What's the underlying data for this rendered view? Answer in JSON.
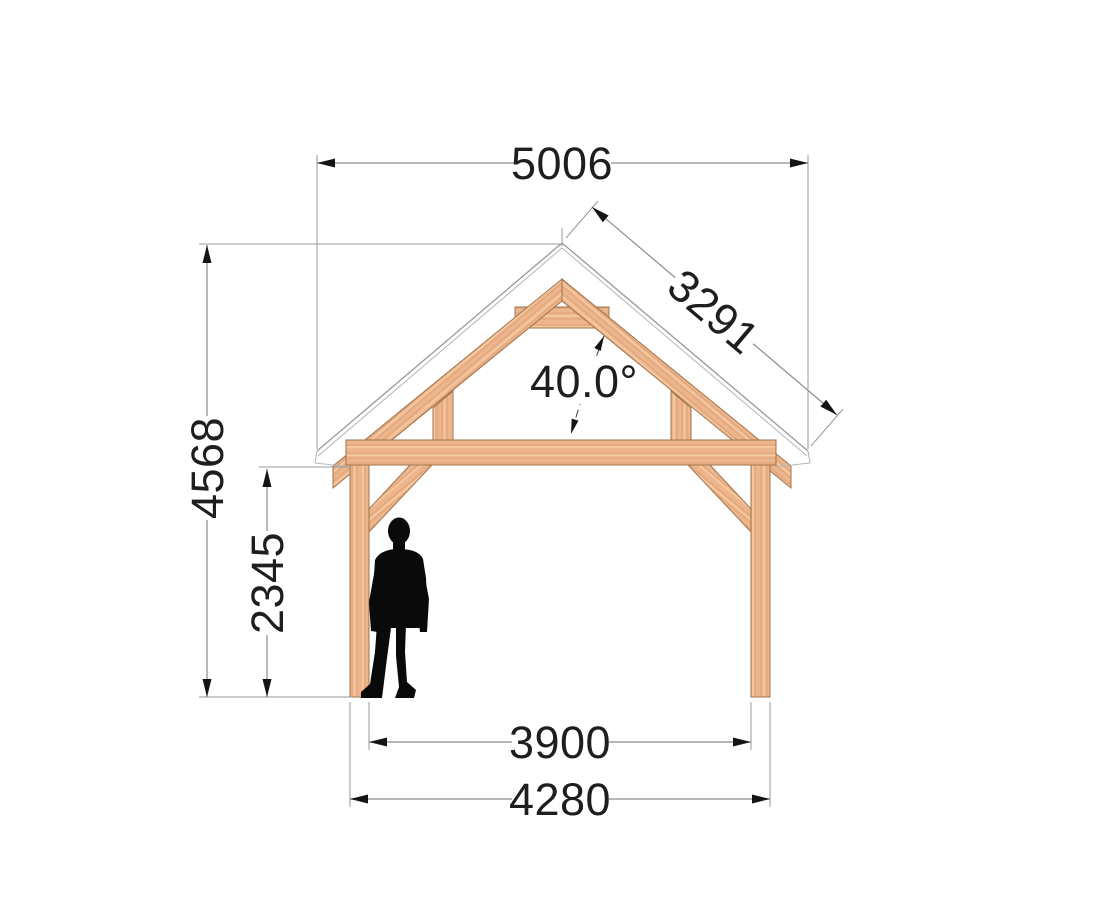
{
  "title": "Timber frame canopy front elevation drawing",
  "dimensions": {
    "top_width": "5006",
    "roof_slope": "3291",
    "roof_angle": "40.0°",
    "total_height": "4568",
    "clear_height": "2345",
    "inner_span": "3900",
    "outer_span": "4280"
  },
  "colors": {
    "wood_base": "#ecb58c",
    "wood_grain_dark": "#d6966b",
    "wood_grain_light": "#f7cda6",
    "wood_edge": "#a1734a",
    "roof_outline": "#9e9e9e",
    "dimension_line": "#8b8b8b",
    "text": "#1e1e1e",
    "silhouette": "#0a0a0a",
    "background": "#ffffff"
  },
  "scale_figure": "human-silhouette"
}
